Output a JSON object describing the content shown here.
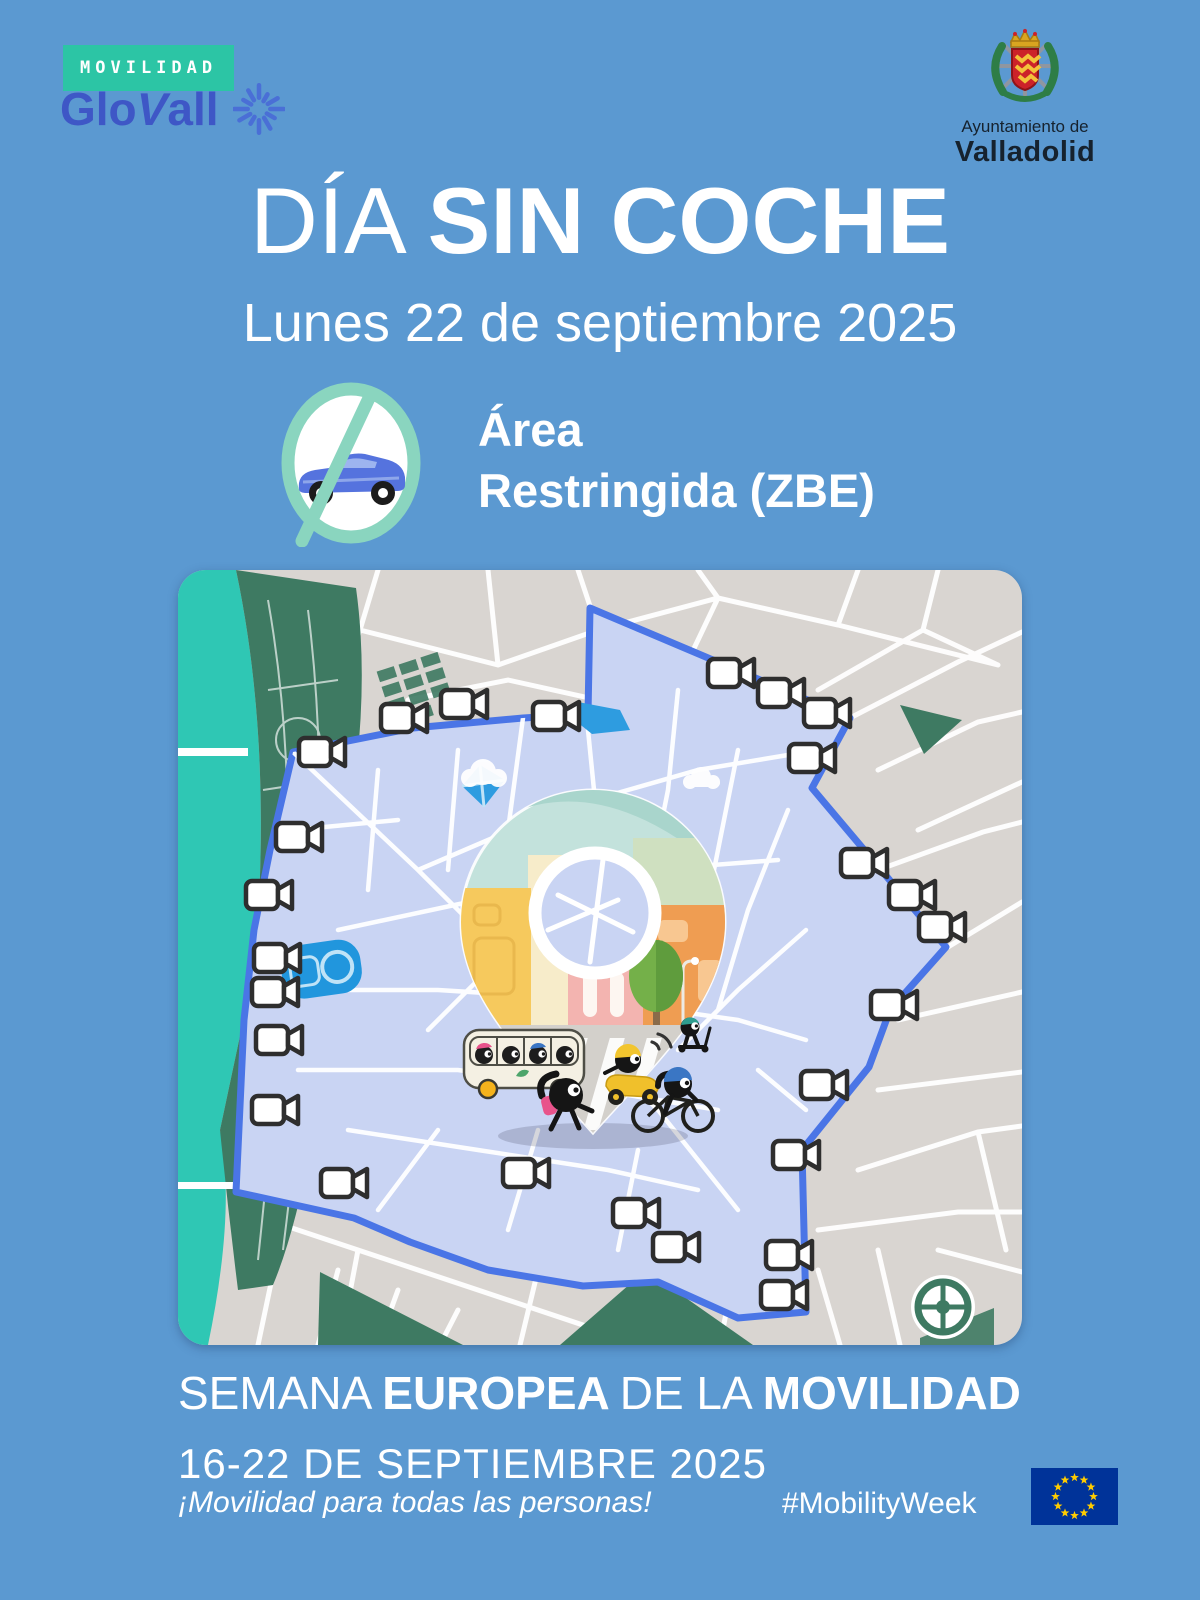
{
  "header": {
    "badge": "MOVILIDAD",
    "brand_glo": "Glo",
    "brand_v": "V",
    "brand_all": "all",
    "brand_icon": "starburst-icon",
    "org_line1": "Ayuntamiento de",
    "org_line2": "Valladolid",
    "org_icon": "valladolid-coat-of-arms"
  },
  "title": {
    "light": "DÍA",
    "bold": "SIN COCHE"
  },
  "subtitle": "Lunes 22 de septiembre 2025",
  "restriction": {
    "icon": "no-car-icon",
    "line1": "Área",
    "line2": "Restringida (ZBE)"
  },
  "map": {
    "description": "stylized city map of Valladolid with restricted low-emission zone (ZBE) outlined in blue and traffic cameras on the perimeter",
    "camera_icon": "video-camera-icon",
    "zone_polygon": [
      [
        115,
        182
      ],
      [
        235,
        158
      ],
      [
        345,
        148
      ],
      [
        410,
        144
      ],
      [
        412,
        38
      ],
      [
        672,
        148
      ],
      [
        634,
        218
      ],
      [
        768,
        377
      ],
      [
        712,
        440
      ],
      [
        691,
        497
      ],
      [
        624,
        580
      ],
      [
        628,
        742
      ],
      [
        560,
        748
      ],
      [
        480,
        712
      ],
      [
        405,
        716
      ],
      [
        310,
        700
      ],
      [
        232,
        672
      ],
      [
        176,
        648
      ],
      [
        58,
        622
      ],
      [
        66,
        450
      ],
      [
        76,
        360
      ],
      [
        92,
        280
      ]
    ],
    "cameras": [
      [
        140,
        182
      ],
      [
        222,
        148
      ],
      [
        282,
        134
      ],
      [
        374,
        146
      ],
      [
        549,
        103
      ],
      [
        599,
        123
      ],
      [
        645,
        143
      ],
      [
        630,
        188
      ],
      [
        682,
        293
      ],
      [
        730,
        325
      ],
      [
        760,
        357
      ],
      [
        712,
        435
      ],
      [
        642,
        515
      ],
      [
        614,
        585
      ],
      [
        607,
        685
      ],
      [
        602,
        725
      ],
      [
        494,
        677
      ],
      [
        454,
        643
      ],
      [
        344,
        603
      ],
      [
        162,
        613
      ],
      [
        93,
        540
      ],
      [
        97,
        470
      ],
      [
        93,
        422
      ],
      [
        95,
        388
      ],
      [
        87,
        325
      ],
      [
        117,
        267
      ]
    ]
  },
  "footer": {
    "w1": "SEMANA",
    "w2": "EUROPEA",
    "w3": "DE LA",
    "w4": "MOVILIDAD",
    "dates": "16-22 DE SEPTIEMBRE 2025",
    "tagline": "¡Movilidad para todas las personas!",
    "hashtag": "#MobilityWeek",
    "eu_flag": "eu-flag-icon"
  },
  "colors": {
    "background": "#5b99d1",
    "badge_teal": "#2cc5a5",
    "brand_blue": "#3e57c6",
    "zone_fill": "#c9d4f3",
    "zone_border": "#4a75e6",
    "map_gray": "#d9d5d1",
    "park_green": "#3e7a62",
    "river_teal": "#2fc7b4",
    "eu_blue": "#003399",
    "eu_star_yellow": "#ffcc00"
  }
}
